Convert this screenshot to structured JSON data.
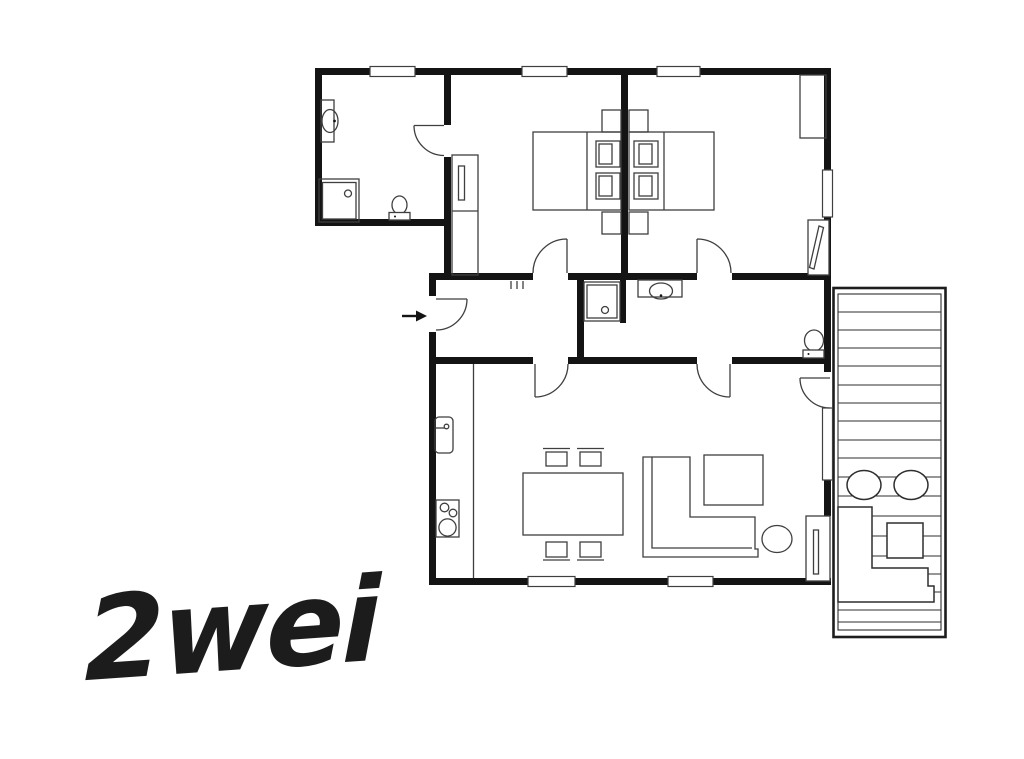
{
  "title": {
    "label": "2wei"
  },
  "colors": {
    "wall": "#141414",
    "furniture_line": "#3f3f3f",
    "background": "#ffffff",
    "title_text": "#1c1c1c"
  },
  "plan": {
    "kind": "apartment-floor-plan",
    "rooms": [
      "bathroom",
      "bedroom-left",
      "bedroom-right",
      "entrance-hall",
      "shower-room",
      "living-room-with-kitchen",
      "terrace"
    ],
    "symbols": [
      "wash-basin",
      "shower-tray",
      "toilet",
      "interior-door-swing",
      "entrance-arrow",
      "coat-hooks",
      "double-bed",
      "pillow",
      "nightstand",
      "wardrobe",
      "radiator",
      "window",
      "fridge",
      "cooktop",
      "dining-table",
      "chair",
      "corner-sofa",
      "coffee-table",
      "side-table",
      "terrace-deck-boards",
      "lounge-chair",
      "outdoor-corner-bench",
      "outdoor-table",
      "terrace-door"
    ]
  }
}
